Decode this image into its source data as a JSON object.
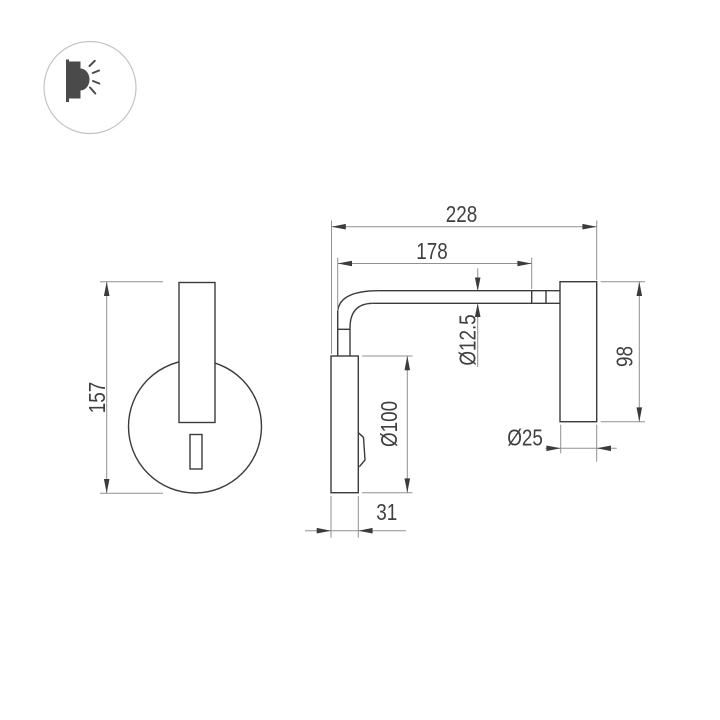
{
  "icon": {
    "name": "wall-lamp-glow-icon"
  },
  "drawing": {
    "type": "technical-dimension-drawing",
    "views": {
      "front_view": "round wall plate with vertical lamp body and switch",
      "side_view": "wall plate, bent arm tube and cylindrical lamp head"
    },
    "dimensions": {
      "total_depth": "228",
      "arm_length": "178",
      "overall_height": "157",
      "tube_diameter": "Ø12.5",
      "plate_diameter": "Ø100",
      "head_length": "98",
      "head_diameter": "Ø25",
      "plate_depth": "31"
    },
    "colors": {
      "object_line": "#3b3b3b",
      "dimension_line": "#909090",
      "label_text": "#3f3f3f",
      "icon_fill": "#4a4a4a",
      "icon_ring": "#c4c4c4",
      "background": "#ffffff"
    }
  }
}
